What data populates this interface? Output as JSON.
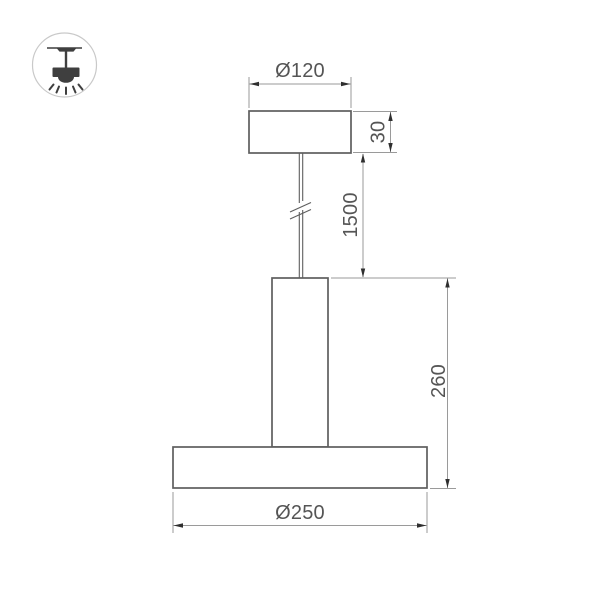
{
  "legend_icon": {
    "name": "pendant-ceiling-light",
    "colors": {
      "circle": "#c9c9c9",
      "glyph": "#3f3f3f"
    }
  },
  "drawing": {
    "type": "technical-dimension-drawing",
    "subject": "pendant-lamp",
    "labels": {
      "canopy_diameter": "Ø120",
      "canopy_height": "30",
      "suspension_length": "1500",
      "body_height": "260",
      "shade_diameter": "Ø250"
    },
    "colors": {
      "outline": "#5e5e5e",
      "dimension_lines": "#9a9a9a",
      "arrows": "#2f2f2f",
      "text": "#555555"
    }
  }
}
